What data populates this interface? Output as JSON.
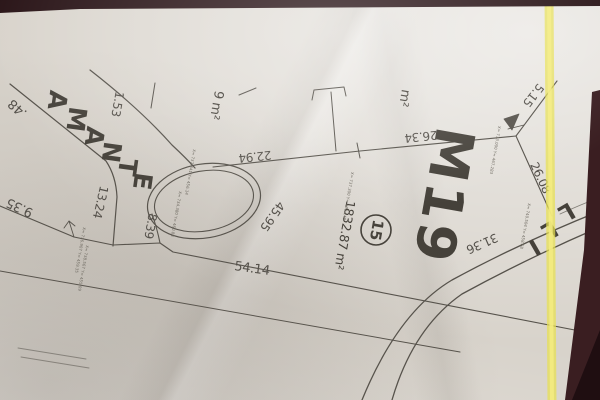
{
  "photo": {
    "paper_color": "#d8d3cb",
    "line_color": "#56524b",
    "text_color": "#45413a",
    "dim_text_color": "#54504a",
    "tiny_text_color": "#6e6a61",
    "highlighter_color": "#e8e050",
    "highlighter_glow": "#f4ec82",
    "edge_top_color": "#2a1518",
    "edge_right_color": "#3a1e21",
    "edge_corner_color": "#1f0e11"
  },
  "plan": {
    "lot": {
      "block_label": "M19",
      "lot_number": "15",
      "area_label": "1832.87 m²"
    },
    "street_name": "AMANTE",
    "street_name_partial": "LLI",
    "paths": [
      {
        "d": "M10,84 Q60,124 106,161 Q116,176 117,197 L113,246",
        "w": 1.2
      },
      {
        "d": "M90,70 Q140,109 172,145 Q186,158 195,168",
        "w": 1.2
      },
      {
        "d": "M152,214 Q157,228 160,243",
        "w": 1.1
      },
      {
        "d": "M0,206 L74,237 L113,245 L160,243 L173,252 L585,332",
        "w": 1.1
      },
      {
        "d": "M0,271 L460,352",
        "w": 1.0
      },
      {
        "d": "M213,167 L360,151 L516,136",
        "w": 1.1
      },
      {
        "d": "M516,136 L557,81",
        "w": 1.1
      },
      {
        "d": "M516,136 L552,216",
        "w": 1.1
      },
      {
        "d": "M331,92 L336,151",
        "w": 1.0
      },
      {
        "d": "M312,100 L314,90 L344,87 L346,96",
        "w": 1.0
      },
      {
        "d": "M239,95 L256,88",
        "w": 1.0
      },
      {
        "d": "M155,83 L151,108",
        "w": 1.0
      },
      {
        "d": "M18,348 L86,359",
        "w": 0.9,
        "o": 0.55
      },
      {
        "d": "M21,357 L89,368",
        "w": 0.9,
        "o": 0.55
      },
      {
        "d": "M357,143 L360,158",
        "w": 1.0
      },
      {
        "d": "M600,211 Q520,243 452,280 Q398,312 362,400",
        "w": 1.3
      },
      {
        "d": "M600,227 Q528,258 462,294 Q413,328 392,400",
        "w": 1.3
      },
      {
        "d": "M560,214 Q580,205 598,198",
        "w": 0.9,
        "o": 0.7
      },
      {
        "d": "M74,237 L69,221 M69,221 L64,228 M69,221 L75,226",
        "w": 0.9
      },
      {
        "d": "M508,129 L524,125",
        "w": 0.9
      },
      {
        "d": "M504,119 L519,114 L512,130 Z",
        "w": 0.8,
        "fill": true
      }
    ],
    "ellipses": [
      {
        "cx": 204,
        "cy": 201,
        "rx": 57,
        "ry": 37,
        "rot": -10,
        "w": 1.2
      },
      {
        "cx": 204,
        "cy": 201,
        "rx": 50,
        "ry": 30,
        "rot": -10,
        "w": 1.1
      }
    ],
    "lot_circle": {
      "cx": 376,
      "cy": 230,
      "r": 15,
      "w": 1.6
    },
    "labels": [
      {
        "t": "M19",
        "x": 440,
        "y": 195,
        "r": 100,
        "s": 54,
        "b": 1,
        "ls": 3,
        "name": "block-label"
      },
      {
        "t": "1832.87 m²",
        "x": 344,
        "y": 235,
        "r": 100,
        "s": 12.5,
        "name": "lot-area-label"
      },
      {
        "t": "m²",
        "x": 404,
        "y": 98,
        "r": 100,
        "s": 13,
        "name": "area-label-partial"
      },
      {
        "t": "9 m²",
        "x": 216,
        "y": 105,
        "r": 100,
        "s": 13,
        "name": "area-label-partial"
      },
      {
        "t": "1.53",
        "x": 117,
        "y": 104,
        "r": 100,
        "s": 12,
        "name": "dimension-label"
      },
      {
        "t": ".48",
        "x": 18,
        "y": 108,
        "r": 222,
        "s": 13,
        "name": "dimension-label"
      },
      {
        "t": "9.35",
        "x": 20,
        "y": 207,
        "r": 205,
        "s": 13,
        "name": "dimension-label"
      },
      {
        "t": "13.24",
        "x": 100,
        "y": 202,
        "r": 103,
        "s": 12,
        "name": "dimension-label"
      },
      {
        "t": "8.39",
        "x": 150,
        "y": 226,
        "r": 100,
        "s": 12,
        "name": "dimension-label"
      },
      {
        "t": "22.94",
        "x": 255,
        "y": 156,
        "r": 174,
        "s": 12,
        "name": "dimension-label"
      },
      {
        "t": "26.34",
        "x": 421,
        "y": 136,
        "r": 174,
        "s": 12,
        "name": "dimension-label"
      },
      {
        "t": "5.15",
        "x": 533,
        "y": 95,
        "r": 128,
        "s": 12,
        "name": "dimension-label"
      },
      {
        "t": "26.08",
        "x": 540,
        "y": 178,
        "r": 65,
        "s": 12,
        "name": "dimension-label"
      },
      {
        "t": "45.95",
        "x": 272,
        "y": 216,
        "r": 125,
        "s": 12,
        "name": "dimension-label"
      },
      {
        "t": "54.14",
        "x": 252,
        "y": 269,
        "r": 8,
        "s": 13,
        "name": "dimension-label"
      },
      {
        "t": "31.36",
        "x": 482,
        "y": 243,
        "r": 156,
        "s": 12,
        "name": "dimension-label"
      }
    ],
    "street_letters": [
      {
        "t": "A",
        "x": 56,
        "y": 100
      },
      {
        "t": "M",
        "x": 75,
        "y": 119
      },
      {
        "t": "A",
        "x": 93,
        "y": 136
      },
      {
        "t": "N",
        "x": 110,
        "y": 152
      },
      {
        "t": "T",
        "x": 126,
        "y": 167
      },
      {
        "t": "E",
        "x": 141,
        "y": 181
      }
    ],
    "street_letters_rot": 98,
    "street_letters_size": 25,
    "partial_letters": [
      {
        "t": "L",
        "x": 566,
        "y": 211
      },
      {
        "t": "L",
        "x": 549,
        "y": 229
      },
      {
        "t": "I",
        "x": 534,
        "y": 246
      }
    ],
    "partial_letters_rot": 150,
    "partial_letters_size": 23,
    "vertex_coordinates": [
      {
        "t": "X= 733.000  Y= 467.283",
        "x": 495,
        "y": 150
      },
      {
        "t": "X= 737.341  Y= 456.14",
        "x": 190,
        "y": 172
      },
      {
        "t": "X= 737.300  Y= 493.148",
        "x": 348,
        "y": 196
      },
      {
        "t": "X= 734.380  Y= 460.84",
        "x": 176,
        "y": 214
      },
      {
        "t": "X= 736.907  Y= 459.35",
        "x": 80,
        "y": 250
      },
      {
        "t": "X= 738.567  Y= 455.09",
        "x": 83,
        "y": 268
      },
      {
        "t": "X= 740.504  Y= 458.68",
        "x": 525,
        "y": 226
      }
    ],
    "highlighter": {
      "d": "M549,-4 C549,110 551,230 552,404",
      "width_outer": 9,
      "width_inner": 4,
      "opacity_outer": 0.72,
      "opacity_inner": 0.85
    },
    "edges": {
      "top": "M0,0 H600 V6 L80,9 L0,13 Z",
      "right": "M592,92 L600,90 L600,400 L565,400 L584,250 Z",
      "corner": "M600,330 L600,400 L572,400 Z"
    }
  }
}
